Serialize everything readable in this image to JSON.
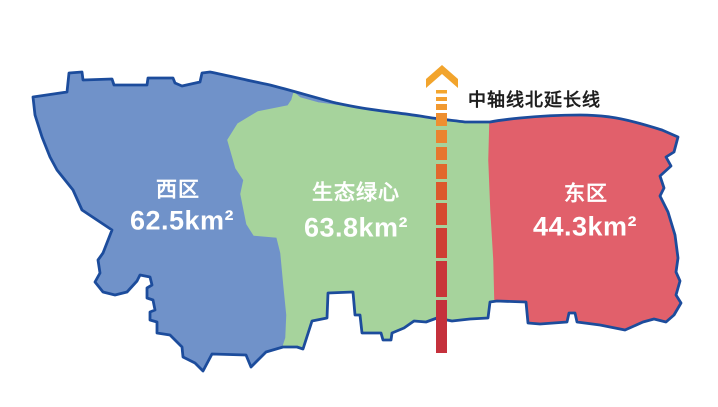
{
  "regions": [
    {
      "id": "west",
      "name": "西区",
      "area": "62.5km²",
      "fill": "#7092C9"
    },
    {
      "id": "green-heart",
      "name": "生态绿心",
      "area": "63.8km²",
      "fill": "#A6D39C"
    },
    {
      "id": "east",
      "name": "东区",
      "area": "44.3km²",
      "fill": "#E1606B"
    }
  ],
  "axis": {
    "label": "中轴线北延长线",
    "arrow_color": "#F2A42C",
    "dash_colors": [
      "#F4A62E",
      "#F3A030",
      "#F19931",
      "#EE8F30",
      "#EB8330",
      "#E7762E",
      "#E2672D",
      "#DC582C",
      "#D64A2F",
      "#CF3E33",
      "#C93638",
      "#C5313C"
    ]
  },
  "colors": {
    "border": "#1C4C9C",
    "background": "#FFFFFF",
    "region_label_text": "#FFFFFF",
    "axis_label_text": "#1F1F1F"
  }
}
